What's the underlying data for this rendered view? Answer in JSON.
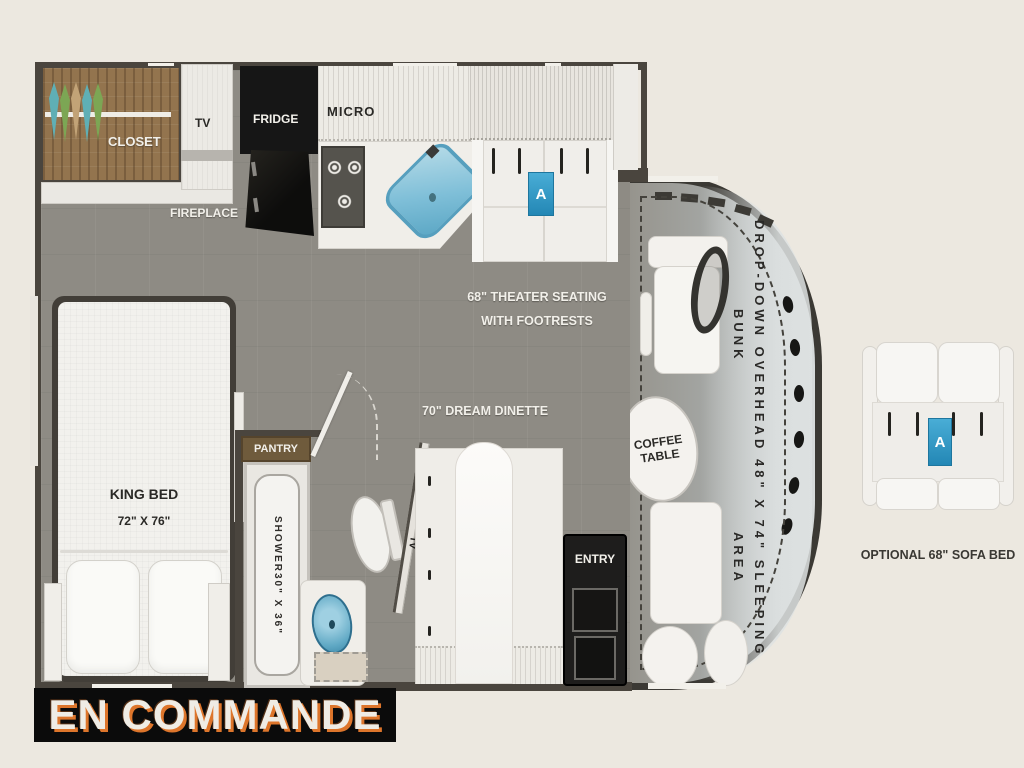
{
  "banner": {
    "text": "EN COMMANDE"
  },
  "plan": {
    "bedroom": {
      "closet": "CLOSET",
      "tv": "TV",
      "fireplace": "FIREPLACE",
      "bed": "KING BED",
      "bed_size": "72\" X 76\""
    },
    "kitchen": {
      "fridge": "FRIDGE",
      "micro": "MICRO",
      "pantry": "PANTRY"
    },
    "bath": {
      "shower": "SHOWER",
      "shower_size": "30\" X 36\"",
      "tv": "TV"
    },
    "living": {
      "theater1": "68\" THEATER SEATING",
      "theater2": "WITH FOOTRESTS",
      "dinette": "70\" DREAM DINETTE",
      "entry": "ENTRY",
      "tag": "A"
    },
    "cab": {
      "coffee1": "COFFEE",
      "coffee2": "TABLE",
      "bunk1": "DROP-DOWN OVERHEAD BUNK",
      "bunk2": "48\" X 74\" SLEEPING AREA"
    },
    "option": {
      "label": "OPTIONAL 68\" SOFA BED",
      "tag": "A"
    }
  },
  "colors": {
    "background": "#ECE8E0",
    "wall": "#4A453E",
    "floor": "#8E8B84",
    "tag_blue": "#2F9CC9",
    "sink_blue": "#7FBFD8",
    "closet_wood": "#93744E",
    "banner_bg": "#0B0B0B",
    "banner_text": "#EFECE5",
    "banner_shadow": "#DD752B"
  }
}
